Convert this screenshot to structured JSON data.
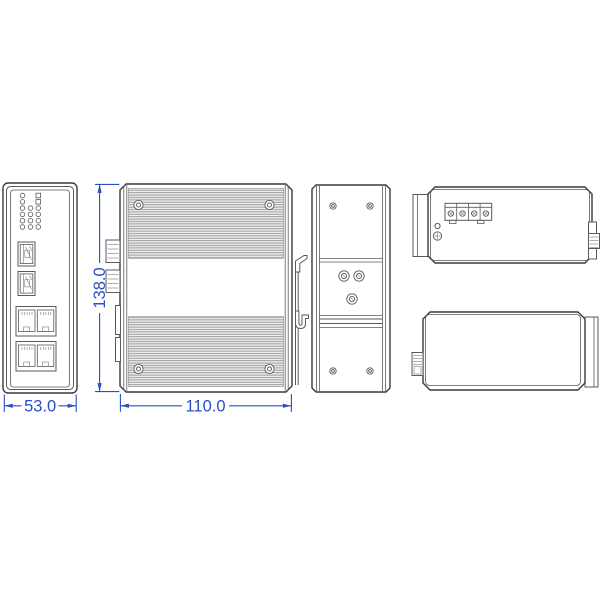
{
  "drawing": {
    "dimensions": {
      "front_width": "53.0",
      "height": "138.0",
      "depth": "110.0"
    },
    "colors": {
      "dimension_blue": "#2a4ec6",
      "outline_dark": "#3a3a3a",
      "outline_mid": "#5a5a5a",
      "fin_line": "#8f8f8f",
      "fin_bg": "#f1f1f1"
    }
  }
}
